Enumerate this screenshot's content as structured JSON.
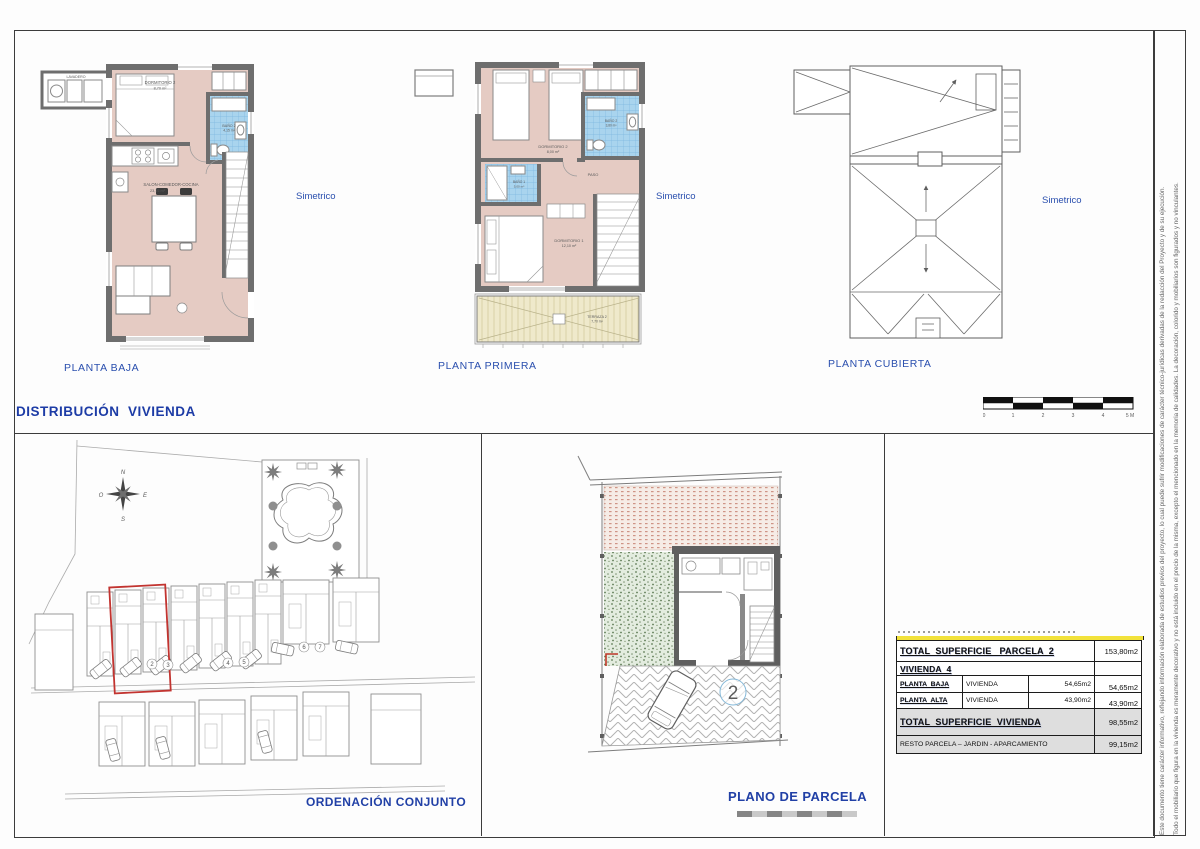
{
  "header": {
    "title": "DISTRIBUCIÓN  VIVIENDA"
  },
  "plans": {
    "baja": {
      "label": "PLANTA BAJA",
      "simetrico": "Simetrico",
      "lavadero": "LAVADERO",
      "dormitorio2": "DORMITORIO 2",
      "dormitorio2_area": "8,70 m²",
      "bano2": "BAÑO 2",
      "bano2_area": "4,15 m²",
      "salon": "SALON-COMEDOR-COCINA",
      "salon_area": "23,15 m²"
    },
    "primera": {
      "label": "PLANTA PRIMERA",
      "simetrico": "Simetrico",
      "dormitorio2": "DORMITORIO 2",
      "dormitorio2_area": "8,00 m²",
      "bano2": "BAÑO 2",
      "bano2_area": "3,80 m²",
      "bano1": "BAÑO 1",
      "bano1_area": "5,00 m²",
      "paso": "PASO",
      "dormitorio1": "DORMITORIO 1",
      "dormitorio1_area": "12,10 m²",
      "terraza": "TERRAZA 2",
      "terraza_area": "7,70 m²"
    },
    "cubierta": {
      "label": "PLANTA CUBIERTA",
      "simetrico": "Simetrico"
    }
  },
  "scalebar": {
    "t0": "0",
    "t1": "1",
    "t2": "2",
    "t3": "3",
    "t4": "4",
    "t5": "5 M"
  },
  "ordenacion": {
    "label": "ORDENACIÓN CONJUNTO",
    "compass": {
      "n": "N",
      "s": "S",
      "e": "E",
      "o": "O"
    },
    "unit_numbers": [
      "2",
      "3",
      "4",
      "5",
      "6",
      "7"
    ]
  },
  "parcela": {
    "label": "PLANO DE PARCELA",
    "number": "2"
  },
  "table": {
    "total_parcela_label": "TOTAL  SUPERFICIE   PARCELA  2",
    "total_parcela_value": "153,80m2",
    "vivienda_label": "VIVIENDA  4",
    "pb_label": "PLANTA  BAJA",
    "pb_mid": "VIVIENDA",
    "pb_value": "54,65m2",
    "pb_total": "54,65m2",
    "pa_label": "PLANTA  ALTA",
    "pa_mid": "VIVIENDA",
    "pa_value": "43,90m2",
    "pa_total": "43,90m2",
    "total_viv_label": "TOTAL  SUPERFICIE  VIVIENDA",
    "total_viv_value": "98,55m2",
    "resto_label": "RESTO PARCELA – JARDIN - APARCAMIENTO",
    "resto_value": "99,15m2"
  },
  "disclaimer": {
    "line1": "Este documento tiene carácter informativo, reflejando información elaborada de estudios previos del proyecto, lo cual puede sufrir modificaciones de carácter técnico-jurídicas derivadas de la redacción del Proyecto y de su ejecución.",
    "line2": "Todo el mobiliario que figura en la vivienda es meramente decorativo y no está incluido en el precio de la misma, excepto el mencionado en la memoria de calidades. La decoración, colorido y mobiliarios son figurados y no vinculantes."
  },
  "colors": {
    "blue_label": "#2a4fae",
    "floor_pink": "#e5cbc3",
    "bath_blue": "#a9d4ee",
    "wall_gray": "#6e6e6e",
    "terraza_beige": "#efe9cb",
    "highlight_red": "#c23430",
    "table_highlight_yellow": "#f2e23a"
  }
}
